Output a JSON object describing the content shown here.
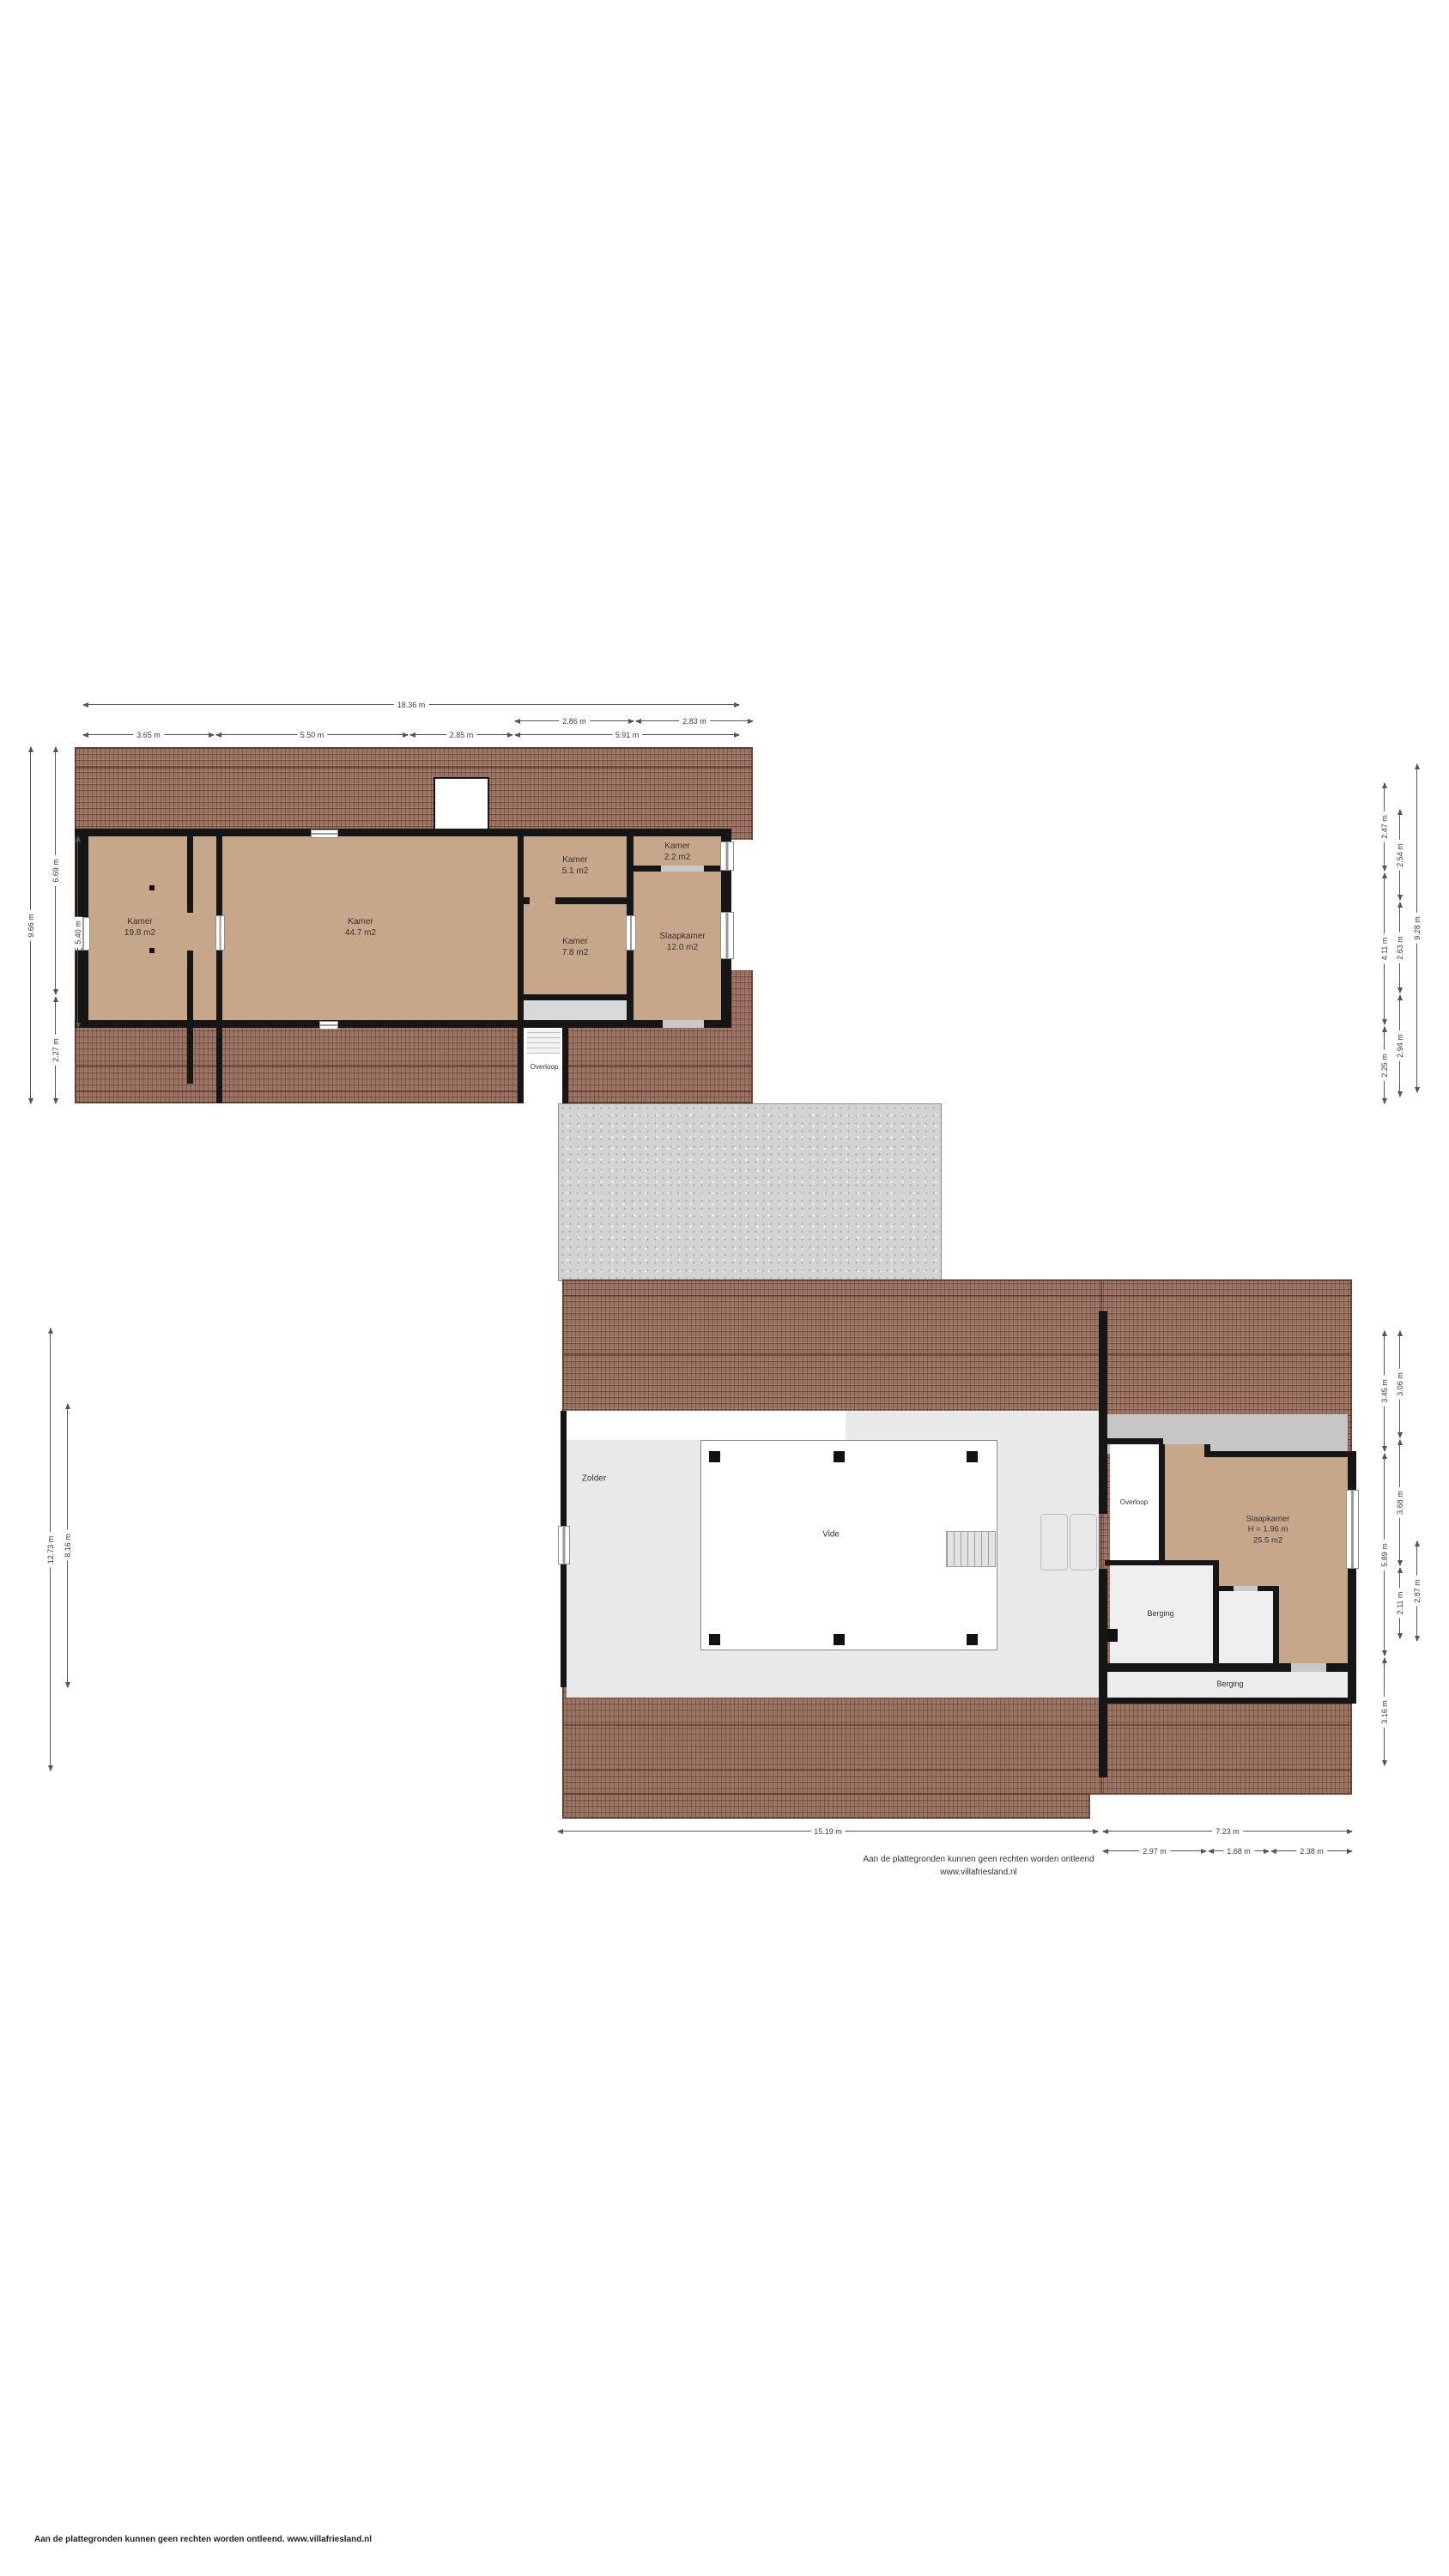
{
  "floor1": {
    "rooms": {
      "kamer_198": {
        "name": "Kamer",
        "area": "19.8 m2"
      },
      "kamer_447": {
        "name": "Kamer",
        "area": "44.7 m2"
      },
      "kamer_51": {
        "name": "Kamer",
        "area": "5.1 m2"
      },
      "kamer_22": {
        "name": "Kamer",
        "area": "2.2 m2"
      },
      "kamer_78": {
        "name": "Kamer",
        "area": "7.8 m2"
      },
      "slaapkamer_120": {
        "name": "Slaapkamer",
        "area": "12.0 m2"
      },
      "overloop": {
        "name": "Overloop"
      }
    },
    "dims": {
      "top_total": "18.36 m",
      "top_sub": [
        "2.86 m",
        "2.83 m"
      ],
      "top_segments": [
        "3.65 m",
        "5.50 m",
        "2.85 m",
        "5.91 m"
      ],
      "left_outer": "9.66 m",
      "left_mid": [
        "6.69 m",
        "2.27 m"
      ],
      "left_inner": "5.40 m",
      "right_inner": [
        "2.47 m",
        "4.11 m",
        "2.25 m"
      ],
      "right_mid": [
        "2.54 m",
        "2.63 m",
        "2.94 m"
      ],
      "right_outer": "9.28 m"
    }
  },
  "floor2": {
    "rooms": {
      "zolder": {
        "name": "Zolder"
      },
      "vide": {
        "name": "Vide"
      },
      "overloop": {
        "name": "Overloop"
      },
      "slaapkamer": {
        "name": "Slaapkamer",
        "height": "H = 1.96 m",
        "area": "25.5 m2"
      },
      "berging_boven": {
        "name": "Berging"
      },
      "berging_onder": {
        "name": "Berging"
      }
    },
    "dims": {
      "left_outer": "12.73 m",
      "left_inner": "8.16 m",
      "right_inner": [
        "3.45 m",
        "5.89 m",
        "3.16 m"
      ],
      "right_mid": [
        "3.06 m",
        "3.68 m",
        "2.11 m"
      ],
      "right_outer": "2.87 m",
      "bottom_left": "15.19 m",
      "bottom_right": "7.23 m",
      "bottom_sub": [
        "2.97 m",
        "1.68 m",
        "2.38 m"
      ]
    },
    "disclaimer": {
      "line1": "Aan de plattegronden kunnen geen rechten worden ontleend",
      "line2": "www.villafriesland.nl"
    }
  },
  "page_footer": {
    "text": "Aan de plattegronden kunnen geen rechten worden ontleend. www.villafriesland.nl"
  },
  "colors": {
    "tile": "#9c7463",
    "floor": "#c7a78a",
    "wall": "#161616",
    "concrete": "#d3d3d3"
  }
}
